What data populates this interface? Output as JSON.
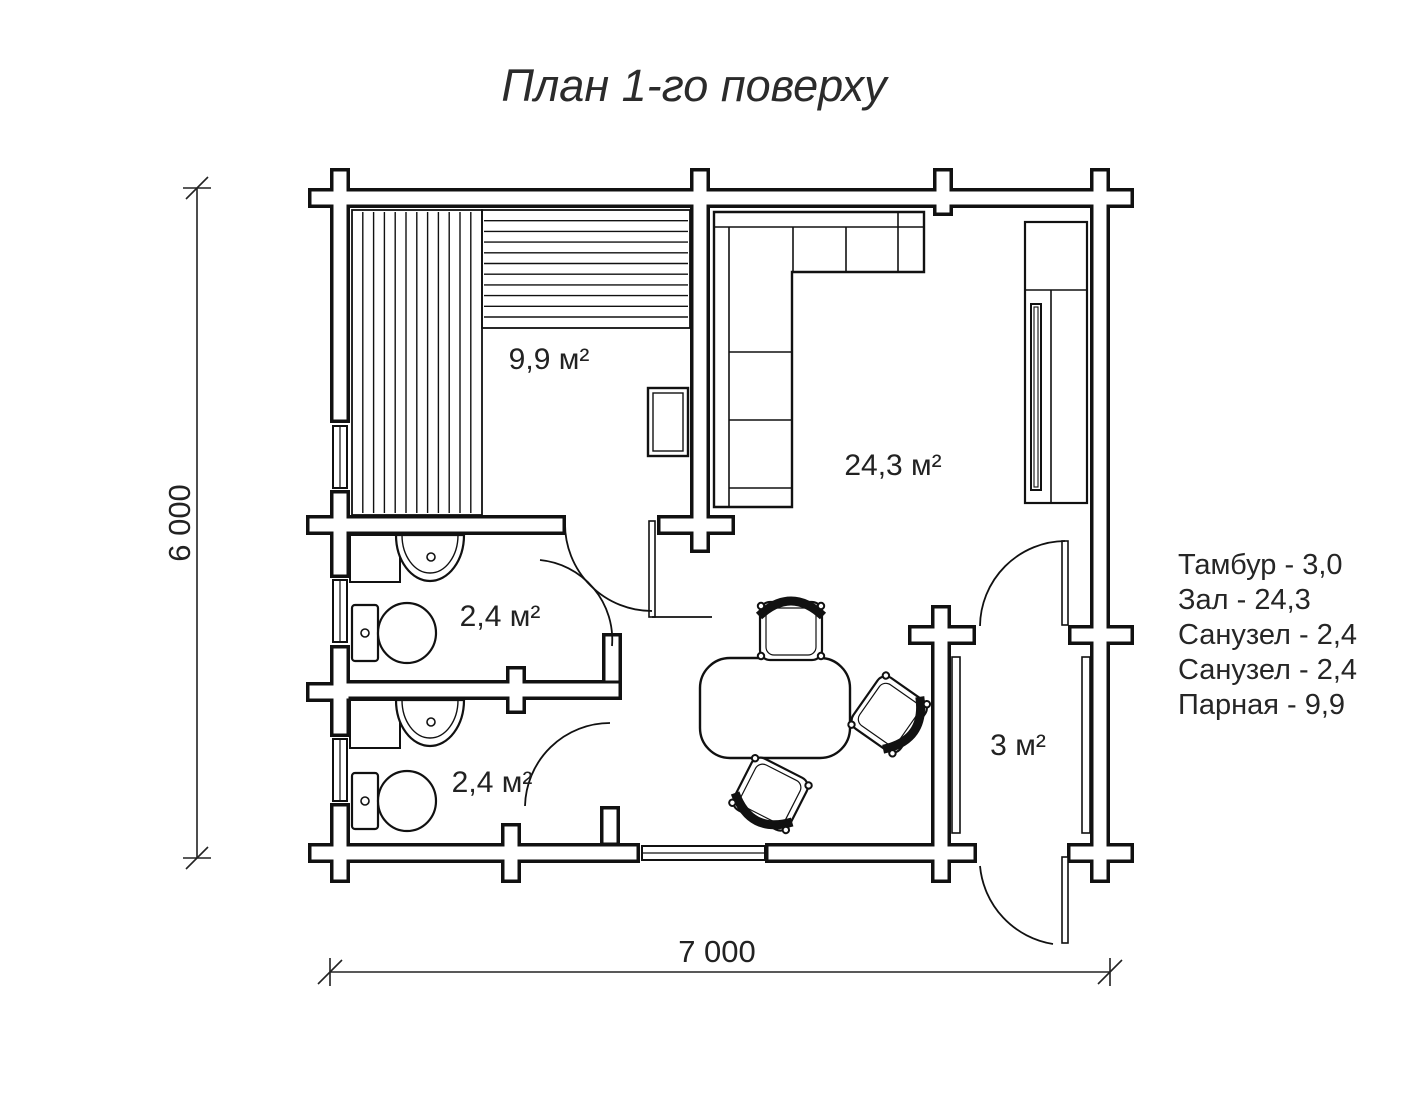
{
  "title": "План 1-го поверху",
  "rooms": {
    "parnaya": {
      "area_label": "9,9 м²"
    },
    "zal": {
      "area_label": "24,3 м²"
    },
    "sanuzel1": {
      "area_label": "2,4 м²"
    },
    "sanuzel2": {
      "area_label": "2,4 м²"
    },
    "tambur": {
      "area_label": "3 м²"
    }
  },
  "dimensions": {
    "width_label": "7 000",
    "height_label": "6 000"
  },
  "legend": {
    "items": [
      {
        "label": "Тамбур - 3,0"
      },
      {
        "label": "Зал - 24,3"
      },
      {
        "label": "Санузел - 2,4"
      },
      {
        "label": "Санузел - 2,4"
      },
      {
        "label": "Парная - 9,9"
      }
    ]
  },
  "colors": {
    "ink": "#111111",
    "background": "#ffffff"
  }
}
